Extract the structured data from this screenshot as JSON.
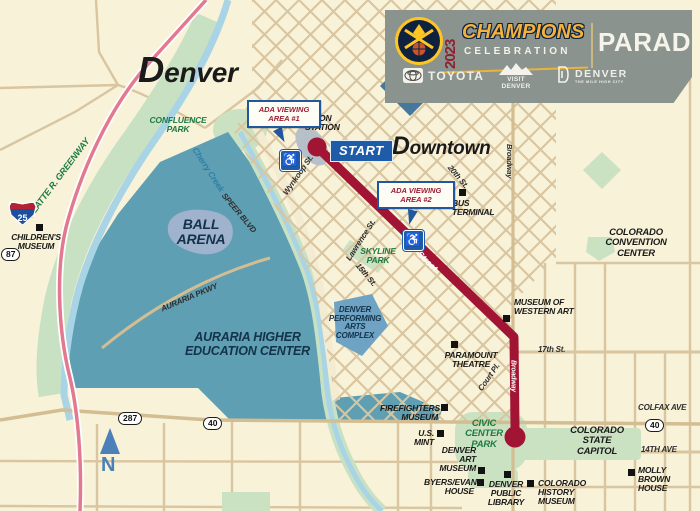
{
  "banner": {
    "year": "2023",
    "title": "CHAMPIONS",
    "subtitle": "CELEBRATION",
    "right_label": "PARADE",
    "sponsor_toyota": "TOYOTA",
    "sponsor_visit_denver": "VISIT DENVER",
    "sponsor_denver": "DENVER",
    "sponsor_denver_tagline": "THE MILE HIGH CITY"
  },
  "colors": {
    "banner_bg": "#8B938E",
    "gold": "#F3B23B",
    "maroon": "#8B2332",
    "navy": "#0E2240",
    "map_background": "#F8F2D8",
    "water_area": "#5E9FB3",
    "river": "#A8D4E6",
    "park_green": "#CBE2C2",
    "road_tan": "#D9C5A0",
    "route_red": "#A11433",
    "highway_pink": "#E2798F",
    "ada_blue": "#1E5CA8",
    "park_label_green": "#1D7A43"
  },
  "map": {
    "labels": {
      "city": "Denver",
      "downtown": "Downtown",
      "start": "START",
      "ada_area_1": "ADA VIEWING AREA #1",
      "ada_area_2": "ADA VIEWING AREA #2",
      "union_station": "UNION STATION",
      "confluence_park": "CONFLUENCE PARK",
      "platte_greenway": "PLATTE R. GREENWAY",
      "cherry_creek": "Cherry Creek",
      "childrens_museum": "CHILDREN'S MUSEUM",
      "ball_arena": "BALL ARENA",
      "auraria": "AURARIA HIGHER EDUCATION CENTER",
      "dpac": "DENVER PERFORMING ARTS COMPLEX",
      "skyline_park": "SKYLINE PARK",
      "seventeenth_route": "17th Street",
      "wynkoop": "Wynkoop St.",
      "lawrence": "Lawrence St.",
      "fifteenth": "15th St.",
      "twentieth": "20th St.",
      "speer": "SPEER BLVD",
      "auraria_pkwy": "AURARIA PKWY",
      "broadway_north": "Broadway",
      "broadway_route": "Broadway",
      "court_pl": "Court Pl.",
      "bus_terminal": "BUS TERMINAL",
      "convention_center": "COLORADO CONVENTION CENTER",
      "museum_western_art": "MUSEUM OF WESTERN ART",
      "seventeenth_east": "17th St.",
      "paramount": "PARAMOUNT THEATRE",
      "firefighters": "FIREFIGHTERS MUSEUM",
      "us_mint": "U.S. MINT",
      "civic_center_park": "CIVIC CENTER PARK",
      "state_capitol": "COLORADO STATE CAPITOL",
      "colfax": "COLFAX AVE",
      "fourteenth_ave": "14TH AVE",
      "molly_brown": "MOLLY BROWN HOUSE",
      "denver_art_museum": "DENVER ART MUSEUM",
      "byers_evans": "BYERS/EVANS HOUSE",
      "public_library": "DENVER PUBLIC LIBRARY",
      "history_museum": "COLORADO HISTORY MUSEUM",
      "north": "N"
    },
    "shields": {
      "i25": "25",
      "s87": "87",
      "s287": "287",
      "s40_west": "40",
      "s40_colfax": "40"
    }
  }
}
